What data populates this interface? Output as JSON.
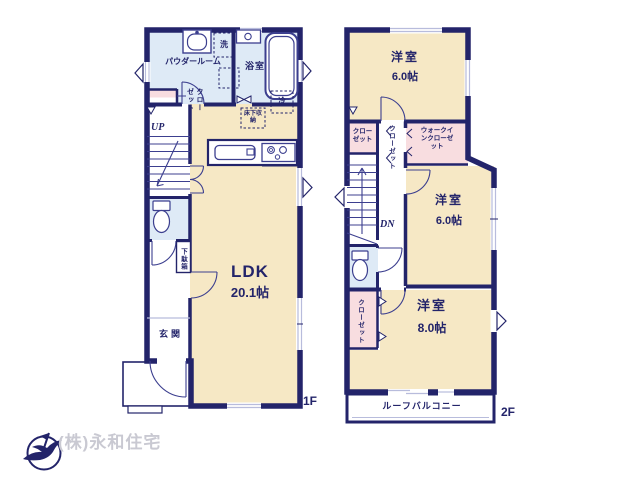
{
  "document_type": "floor-plan",
  "plan": {
    "floor1": {
      "floor_label": "1F",
      "ldk_label": "LDK",
      "ldk_size": "20.1帖",
      "powder_room": "パウダールーム",
      "washer": "洗",
      "bathroom": "浴室",
      "closet": "クローゼット",
      "fridge": "冷",
      "underfloor_storage": "床下収納",
      "up": "UP",
      "shoe_cabinet": "下駄箱",
      "entrance": "玄関"
    },
    "floor2": {
      "floor_label": "2F",
      "western_room": "洋室",
      "size_6": "6.0帖",
      "size_8": "8.0帖",
      "closet": "クローゼット",
      "walk_in_closet": "ウォークインクローゼット",
      "dn": "DN",
      "roof_balcony": "ルーフバルコニー"
    }
  },
  "footer": {
    "company_name": "(株)永和住宅",
    "logo_icon": "bird-compass-logo"
  },
  "colors": {
    "wall": "#23246A",
    "fixture_stroke": "#3C3F8F",
    "room_cream": "#F6E8C5",
    "wet_area_blue": "#DEEAF6",
    "closet_pink": "#F8DDE0",
    "window_line": "#B8BCDC",
    "company_text": "#C9C9D2",
    "background": "#FFFFFF"
  }
}
